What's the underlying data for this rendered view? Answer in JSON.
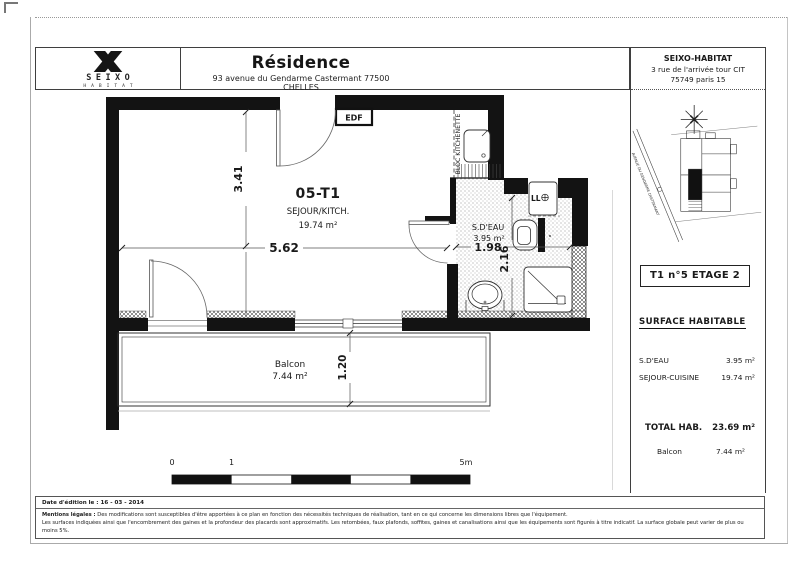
{
  "header": {
    "logo": {
      "brand": "SEIXO",
      "word": "HABITAT"
    },
    "title": "Résidence",
    "address": "93 avenue du Gendarme Castermant 77500 CHELLES",
    "company": {
      "name": "SEIXO-HABITAT",
      "address1": "3 rue de l'arrivée tour CIT",
      "address2": "75749 paris 15"
    }
  },
  "plan": {
    "unit": "05-T1",
    "main_room": "SEJOUR/KITCH.",
    "main_room_area": "19.74 m²",
    "bathroom": "S.D'EAU",
    "bathroom_area": "3.95 m²",
    "balcony": "Balcon",
    "balcony_area": "7.44 m²",
    "kitchenette": "BLOC KITCHENETTE",
    "edf": "EDF",
    "washer": "LL",
    "dim_width": "5.62",
    "dim_height": "3.41",
    "dim_bath_width": "1.98",
    "dim_bath_height": "2.16",
    "dim_balcony": "1.20"
  },
  "siteplan": {
    "street": "AVENUE DU GENDARME CASTERMANT"
  },
  "sidebar": {
    "unit_box": "T1 n°5 ETAGE 2",
    "surface_title": "SURFACE HABITABLE",
    "rows": [
      {
        "label": "S.D'EAU",
        "value": "3.95 m²"
      },
      {
        "label": "SEJOUR-CUISINE",
        "value": "19.74 m²"
      }
    ],
    "total_label": "TOTAL HAB.",
    "total_value": "23.69 m²",
    "balcony_label": "Balcon",
    "balcony_value": "7.44 m²"
  },
  "scalebar": {
    "t0": "0",
    "t1": "1",
    "t5": "5m"
  },
  "footer": {
    "date": "Date d'édition le : 16 - 03 - 2014",
    "legal_title": "Mentions légales :",
    "legal1": "Des modifications sont susceptibles d'être apportées à ce plan en fonction des nécessités techniques de réalisation, tant en ce qui concerne les dimensions libres que l'équipement.",
    "legal2": "Les surfaces indiquées ainsi que l'encombrement des gaines et la profondeur des placards sont approximatifs. Les retombées, faux plafonds, soffites, gaines et canalisations ainsi que les équipements sont figurés à titre indicatif. La surface globale peut varier de plus ou moins 5%."
  }
}
